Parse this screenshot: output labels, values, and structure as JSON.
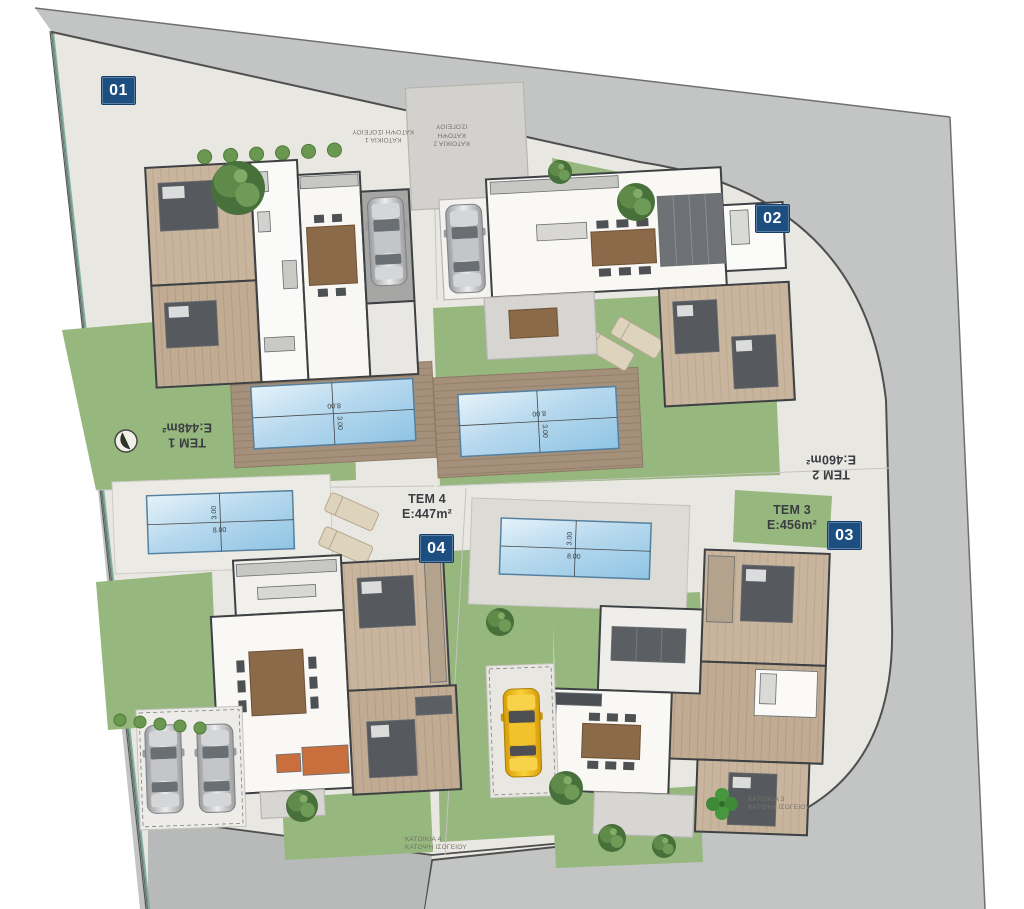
{
  "plan": {
    "plots": [
      {
        "name": "TEM 1",
        "area": "E:448m²"
      },
      {
        "name": "TEM 2",
        "area": "E:460m²"
      },
      {
        "name": "TEM 3",
        "area": "E:456m²"
      },
      {
        "name": "TEM 4",
        "area": "E:447m²"
      }
    ],
    "houses": [
      {
        "badge": "01",
        "name": "ΚΑΤΟΙΚΙΑ 1",
        "floor": "ΚΑΤΟΨΗ ΙΣΟΓΕΙΟΥ"
      },
      {
        "badge": "02",
        "name": "ΚΑΤΟΙΚΙΑ 2",
        "floor": "ΚΑΤΟΨΗ ΙΣΟΓΕΙΟΥ"
      },
      {
        "badge": "03",
        "name": "ΚΑΤΟΙΚΙΑ 3",
        "floor": "ΚΑΤΟΨΗ ΙΣΟΓΕΙΟΥ"
      },
      {
        "badge": "04",
        "name": "ΚΑΤΟΙΚΙΑ 4",
        "floor": "ΚΑΤΟΨΗ ΙΣΟΓΕΙΟΥ"
      }
    ],
    "pool_dims": {
      "length": "8.00",
      "width": "3.00"
    },
    "colors": {
      "badge_blue": "#1d4e80",
      "road_grey": "#c3c4c4",
      "inner_road_grey": "#b8b9b9",
      "concrete": "#e9e7e2",
      "lawn_green": "#96b77d",
      "deck_wood": "#a5907b",
      "pool_blue": "#8fc4e4"
    }
  }
}
